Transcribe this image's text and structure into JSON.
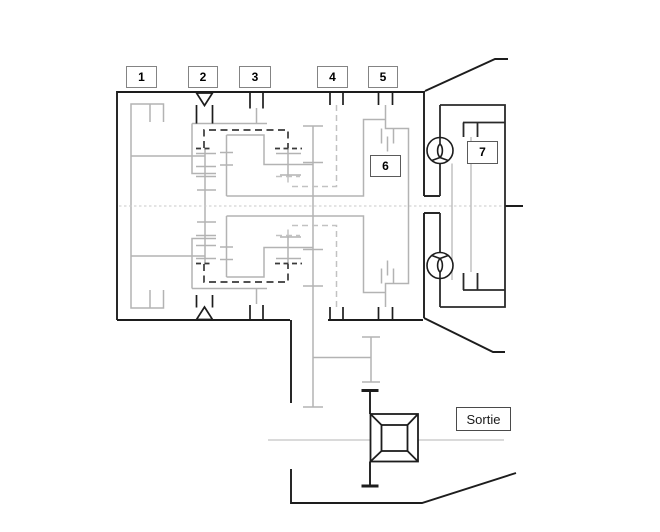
{
  "figure": {
    "title_hint": "transmission-kinematic-schematic",
    "callouts": [
      {
        "id": "1",
        "label": "1"
      },
      {
        "id": "2",
        "label": "2"
      },
      {
        "id": "3",
        "label": "3"
      },
      {
        "id": "4",
        "label": "4"
      },
      {
        "id": "5",
        "label": "5"
      },
      {
        "id": "6",
        "label": "6"
      },
      {
        "id": "7",
        "label": "7"
      }
    ],
    "output_label": "Sortie",
    "colors": {
      "line_dark": "#1d1d1d",
      "line_gray": "#b3b3b3",
      "line_faint": "#c9c9c9",
      "callout_border": "#848484",
      "background": "#ffffff",
      "text": "#000000"
    }
  }
}
